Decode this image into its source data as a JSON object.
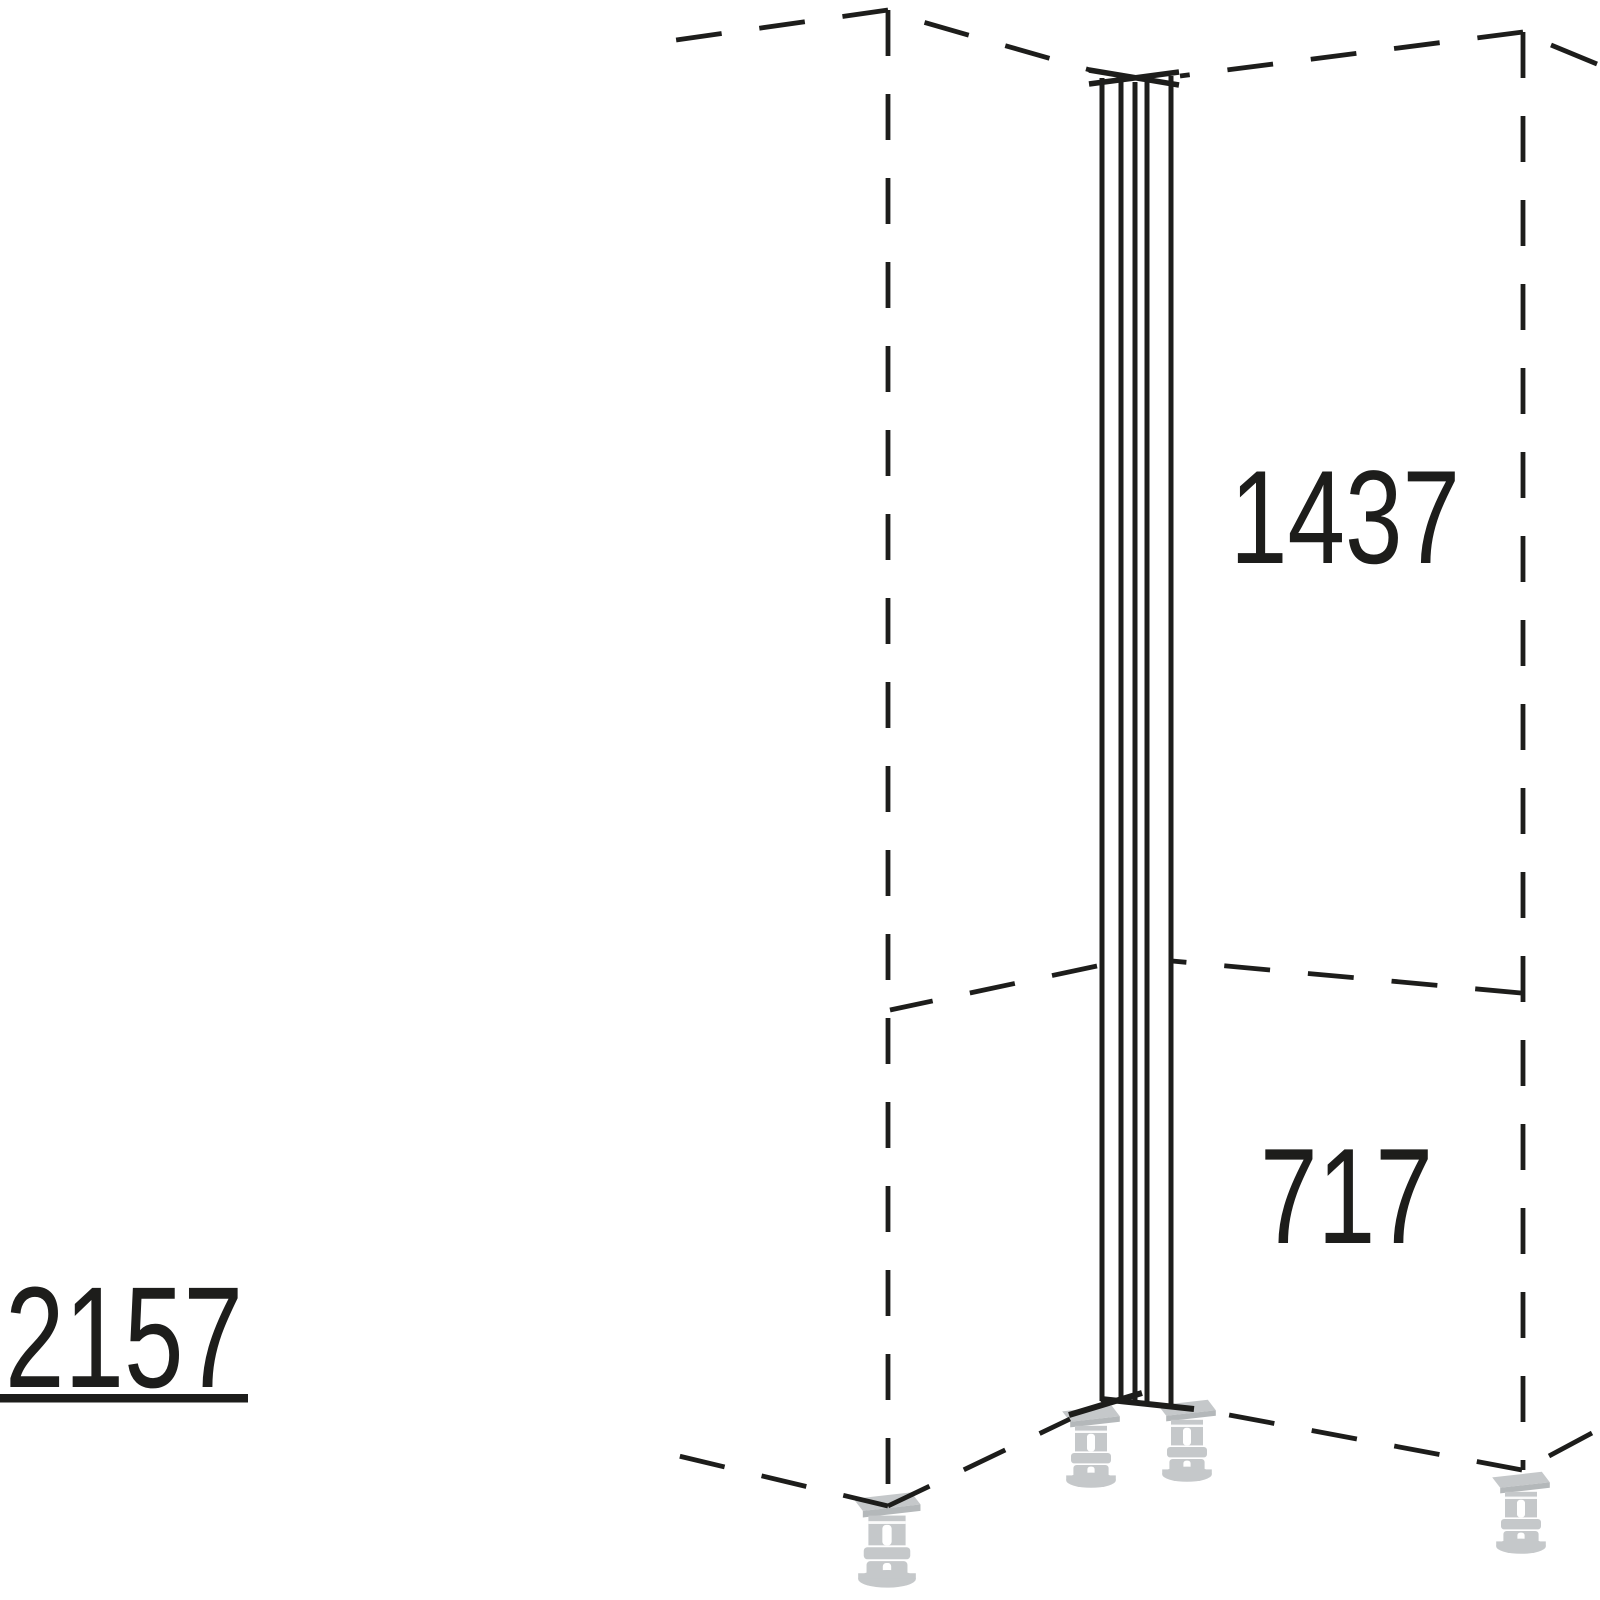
{
  "diagram": {
    "kind": "kitchen-corner-post-technical-drawing",
    "dimension_labels": {
      "upper_section": "1437",
      "lower_section": "717",
      "total_height": "2157"
    },
    "colors": {
      "line": "#1d1d1b",
      "foot_gray": "#c5c8ca",
      "foot_gray_dark": "#b4b8ba",
      "background": "#ffffff"
    }
  }
}
